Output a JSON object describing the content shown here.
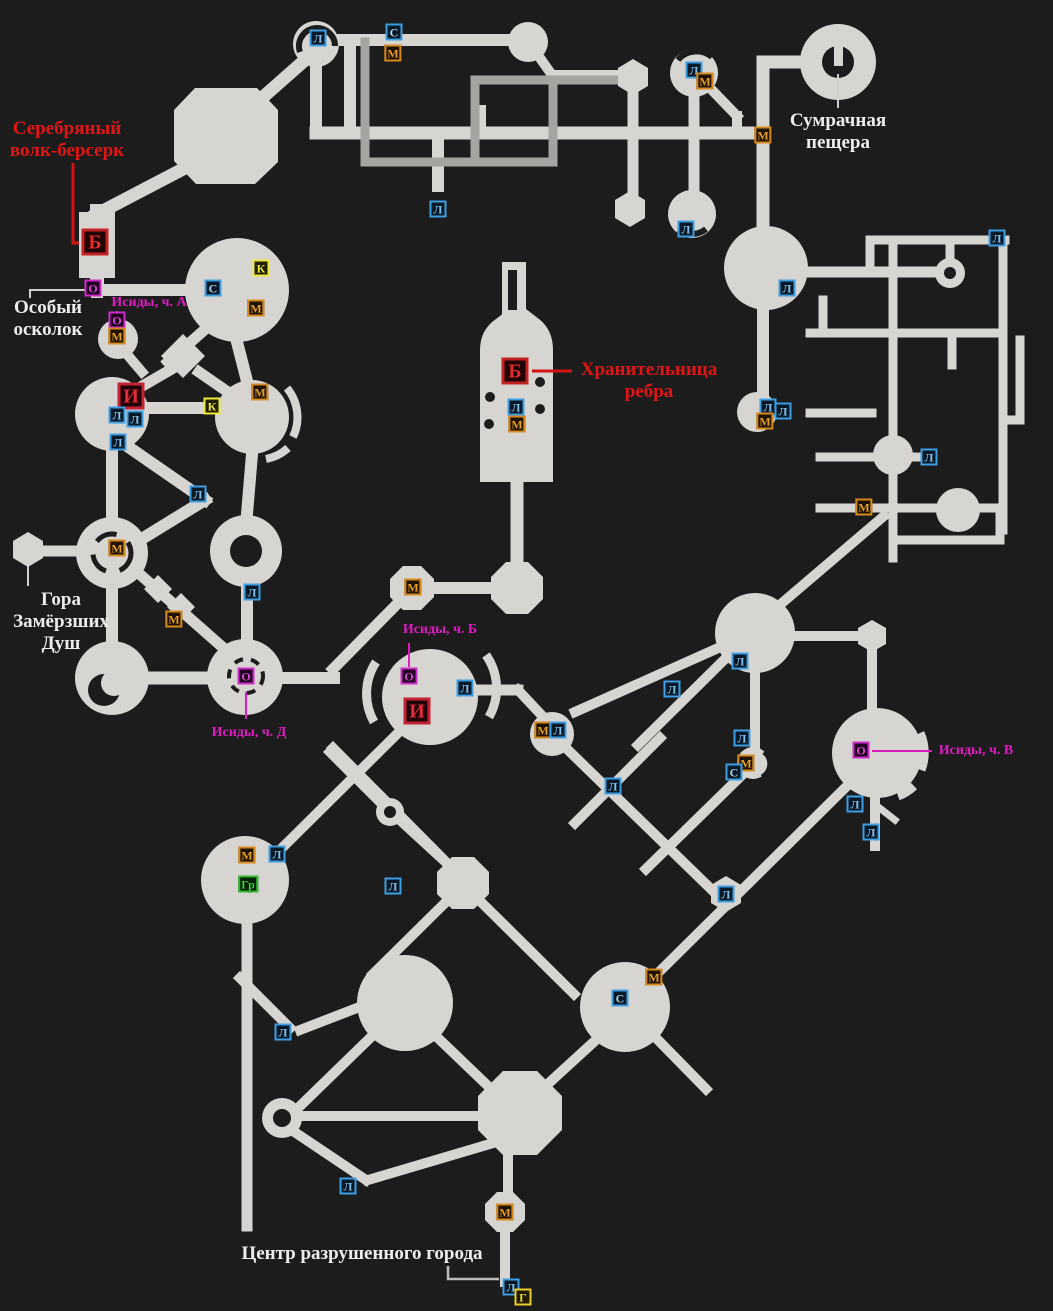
{
  "map": {
    "background": "#1c1c1c",
    "corridor_color": "#d6d5d2",
    "corridor_dark_color": "#a5a4a1"
  },
  "marker_styles": {
    "Л": {
      "border": "#3e9ee3",
      "text": "#7fc2f0",
      "bg": "#0b1b2a"
    },
    "С": {
      "border": "#3e9ee3",
      "text": "#a8d6f5",
      "bg": "#0b1b2a"
    },
    "М": {
      "border": "#d68a1e",
      "text": "#e9a02a",
      "bg": "#221402"
    },
    "К": {
      "border": "#efe93c",
      "text": "#efe93c",
      "bg": "#222002"
    },
    "О": {
      "border": "#cf2bcb",
      "text": "#df46dc",
      "bg": "#230223"
    },
    "Б": {
      "border": "#c32222",
      "text": "#e32c2c",
      "bg": "#250404"
    },
    "И": {
      "border": "#c32230",
      "text": "#e32c3c",
      "bg": "#250408"
    },
    "Г": {
      "border": "#e9cf2e",
      "text": "#f2da35",
      "bg": "#221c02"
    },
    "Гр": {
      "border": "#2eb82e",
      "text": "#3bd43b",
      "bg": "#042204"
    }
  },
  "markers": [
    {
      "type": "Л",
      "x": 318,
      "y": 38,
      "size": "s"
    },
    {
      "type": "С",
      "x": 394,
      "y": 32,
      "size": "s"
    },
    {
      "type": "М",
      "x": 393,
      "y": 53,
      "size": "s"
    },
    {
      "type": "Л",
      "x": 438,
      "y": 209,
      "size": "s"
    },
    {
      "type": "Л",
      "x": 694,
      "y": 70,
      "size": "s"
    },
    {
      "type": "М",
      "x": 705,
      "y": 81,
      "size": "s"
    },
    {
      "type": "М",
      "x": 763,
      "y": 135,
      "size": "s"
    },
    {
      "type": "Л",
      "x": 686,
      "y": 229,
      "size": "s"
    },
    {
      "type": "Б",
      "x": 95,
      "y": 242,
      "size": "l"
    },
    {
      "type": "О",
      "x": 93,
      "y": 288,
      "size": "s"
    },
    {
      "type": "О",
      "x": 117,
      "y": 320,
      "size": "s"
    },
    {
      "type": "М",
      "x": 117,
      "y": 336,
      "size": "s"
    },
    {
      "type": "С",
      "x": 213,
      "y": 288,
      "size": "s"
    },
    {
      "type": "К",
      "x": 261,
      "y": 268,
      "size": "s"
    },
    {
      "type": "М",
      "x": 256,
      "y": 308,
      "size": "s"
    },
    {
      "type": "Л",
      "x": 787,
      "y": 288,
      "size": "s"
    },
    {
      "type": "Л",
      "x": 997,
      "y": 238,
      "size": "s"
    },
    {
      "type": "И",
      "x": 131,
      "y": 396,
      "size": "l"
    },
    {
      "type": "Л",
      "x": 117,
      "y": 415,
      "size": "s"
    },
    {
      "type": "Л",
      "x": 135,
      "y": 419,
      "size": "s"
    },
    {
      "type": "Л",
      "x": 118,
      "y": 442,
      "size": "s"
    },
    {
      "type": "К",
      "x": 212,
      "y": 406,
      "size": "s"
    },
    {
      "type": "М",
      "x": 260,
      "y": 392,
      "size": "s"
    },
    {
      "type": "Л",
      "x": 198,
      "y": 494,
      "size": "s"
    },
    {
      "type": "Б",
      "x": 515,
      "y": 371,
      "size": "l"
    },
    {
      "type": "Л",
      "x": 516,
      "y": 407,
      "size": "s"
    },
    {
      "type": "М",
      "x": 517,
      "y": 424,
      "size": "s"
    },
    {
      "type": "Л",
      "x": 768,
      "y": 407,
      "size": "s"
    },
    {
      "type": "Л",
      "x": 783,
      "y": 411,
      "size": "s"
    },
    {
      "type": "М",
      "x": 765,
      "y": 421,
      "size": "s"
    },
    {
      "type": "Л",
      "x": 929,
      "y": 457,
      "size": "s"
    },
    {
      "type": "М",
      "x": 864,
      "y": 507,
      "size": "s"
    },
    {
      "type": "М",
      "x": 117,
      "y": 548,
      "size": "s"
    },
    {
      "type": "Л",
      "x": 252,
      "y": 592,
      "size": "s"
    },
    {
      "type": "М",
      "x": 174,
      "y": 619,
      "size": "s"
    },
    {
      "type": "О",
      "x": 246,
      "y": 676,
      "size": "s"
    },
    {
      "type": "М",
      "x": 413,
      "y": 587,
      "size": "s"
    },
    {
      "type": "О",
      "x": 409,
      "y": 676,
      "size": "s"
    },
    {
      "type": "Л",
      "x": 465,
      "y": 688,
      "size": "s"
    },
    {
      "type": "И",
      "x": 417,
      "y": 711,
      "size": "l"
    },
    {
      "type": "М",
      "x": 543,
      "y": 730,
      "size": "s"
    },
    {
      "type": "Л",
      "x": 558,
      "y": 730,
      "size": "s"
    },
    {
      "type": "Л",
      "x": 740,
      "y": 661,
      "size": "s"
    },
    {
      "type": "Л",
      "x": 672,
      "y": 689,
      "size": "s"
    },
    {
      "type": "Л",
      "x": 613,
      "y": 786,
      "size": "s"
    },
    {
      "type": "Л",
      "x": 742,
      "y": 738,
      "size": "s"
    },
    {
      "type": "М",
      "x": 746,
      "y": 763,
      "size": "s"
    },
    {
      "type": "С",
      "x": 734,
      "y": 772,
      "size": "s"
    },
    {
      "type": "О",
      "x": 861,
      "y": 750,
      "size": "s"
    },
    {
      "type": "Л",
      "x": 855,
      "y": 804,
      "size": "s"
    },
    {
      "type": "Л",
      "x": 871,
      "y": 832,
      "size": "s"
    },
    {
      "type": "М",
      "x": 247,
      "y": 855,
      "size": "s"
    },
    {
      "type": "Л",
      "x": 277,
      "y": 854,
      "size": "s"
    },
    {
      "type": "Гр",
      "x": 248,
      "y": 884,
      "size": "s"
    },
    {
      "type": "Л",
      "x": 393,
      "y": 886,
      "size": "s"
    },
    {
      "type": "Л",
      "x": 726,
      "y": 894,
      "size": "s"
    },
    {
      "type": "М",
      "x": 654,
      "y": 977,
      "size": "s"
    },
    {
      "type": "С",
      "x": 620,
      "y": 998,
      "size": "s"
    },
    {
      "type": "Л",
      "x": 283,
      "y": 1032,
      "size": "s"
    },
    {
      "type": "Л",
      "x": 348,
      "y": 1186,
      "size": "s"
    },
    {
      "type": "М",
      "x": 505,
      "y": 1212,
      "size": "s"
    },
    {
      "type": "Л",
      "x": 511,
      "y": 1287,
      "size": "s"
    },
    {
      "type": "Г",
      "x": 523,
      "y": 1297,
      "size": "s"
    }
  ],
  "labels": [
    {
      "id": "silver-wolf-berserk",
      "text": "Серебряный\nволк-берсерк",
      "color": "red",
      "x": 67,
      "y": 140
    },
    {
      "id": "special-shard",
      "text": "Особый\nосколок",
      "color": "white",
      "x": 48,
      "y": 319
    },
    {
      "id": "isida-part-a",
      "text": "Исиды, ч. А",
      "color": "magenta",
      "x": 149,
      "y": 303
    },
    {
      "id": "gloomy-cave",
      "text": "Сумрачная\nпещера",
      "color": "white",
      "x": 838,
      "y": 132
    },
    {
      "id": "rib-keeper",
      "text": "Хранительница\nребра",
      "color": "red",
      "x": 649,
      "y": 381
    },
    {
      "id": "mount-frozen-souls",
      "text": "Гора\nЗамёрзших\nДуш",
      "color": "white",
      "x": 61,
      "y": 622
    },
    {
      "id": "isida-part-d",
      "text": "Исиды, ч. Д",
      "color": "magenta",
      "x": 249,
      "y": 733
    },
    {
      "id": "isida-part-b",
      "text": "Исиды, ч. Б",
      "color": "magenta",
      "x": 440,
      "y": 630
    },
    {
      "id": "isida-part-v",
      "text": "Исиды, ч. В",
      "color": "magenta",
      "x": 976,
      "y": 751
    },
    {
      "id": "ruined-city-center",
      "text": "Центр разрушенного города",
      "color": "white",
      "x": 362,
      "y": 1254
    }
  ]
}
